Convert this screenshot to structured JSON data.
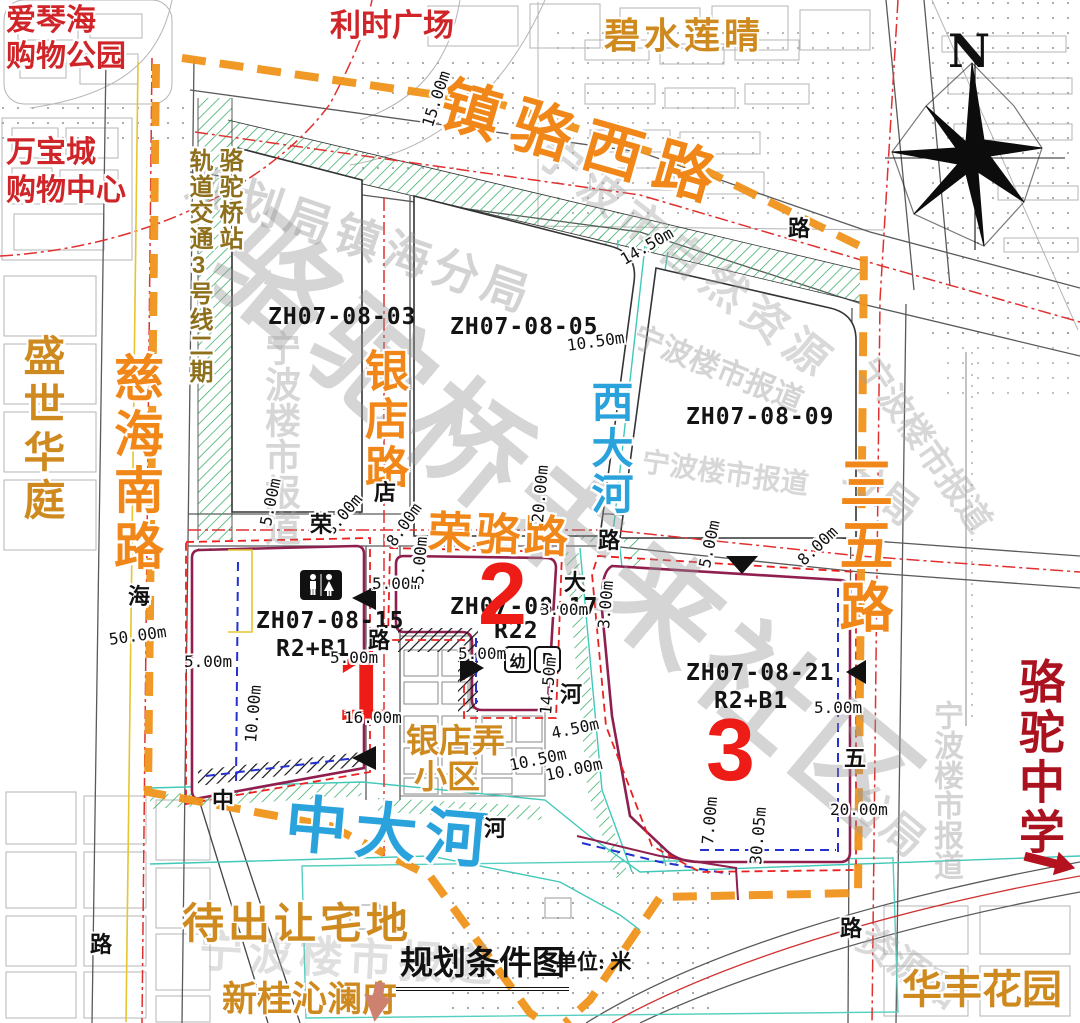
{
  "title": {
    "text": "规划条件图",
    "unit": "单位: 米"
  },
  "compass": {
    "north": "N"
  },
  "roads": {
    "zhenluo_west": "镇骆西路",
    "cihai_south": "慈海南路",
    "yindian": "银店路",
    "rongluo": "荣骆路",
    "sanwu": "三五路"
  },
  "rivers": {
    "zhongda": "中大河",
    "xida": "西大河"
  },
  "rail": {
    "line": "轨道交通3号线二期",
    "station": "骆驼桥站"
  },
  "landmarks": {
    "aiqinhai_1": "爱琴海",
    "aiqinhai_2": "购物公园",
    "lishi": "利时广场",
    "bishui": "碧水莲晴",
    "wanbao_1": "万宝城",
    "wanbao_2": "购物中心",
    "shengshi": "盛世华庭",
    "daichurang": "待出让宅地",
    "xingui": "新桂沁澜府",
    "huafeng": "华丰花园",
    "luotuo_school": "骆驼中学",
    "yindianlong_1": "银店弄",
    "yindianlong_2": "小区"
  },
  "parcels": {
    "p03": {
      "id": "ZH07-08-03"
    },
    "p05": {
      "id": "ZH07-08-05"
    },
    "p09": {
      "id": "ZH07-08-09"
    },
    "p15": {
      "id": "ZH07-08-15",
      "use": "R2+B1",
      "num": "1"
    },
    "p17": {
      "id": "ZH07-08-17",
      "use": "R22",
      "num": "2",
      "kindergarten": "幼",
      "parking": "P"
    },
    "p21": {
      "id": "ZH07-08-21",
      "use": "R2+B1",
      "num": "3"
    }
  },
  "dims": {
    "d01": "15.00m",
    "d02": "14.50m",
    "d03": "10.50m",
    "d04": "5.00m",
    "d05": "8.00m",
    "d06": "8.00m",
    "d07": "5.00m",
    "d08": "20.00m",
    "d09": "5.00m",
    "d10": "3.00m",
    "d11": "5.00m",
    "d12": "3.00m",
    "d13": "5.00m",
    "d14": "8.00m",
    "d15": "5.00m",
    "d16": "20.00m",
    "d17": "7.00m",
    "d18": "30.05m",
    "d19": "16.00m",
    "d20": "10.00m",
    "d21": "5.00m",
    "d22": "50.00m",
    "d23": "5.00m",
    "d24": "14.50m",
    "d25": "10.50m",
    "d26": "10.00m",
    "d27": "4.50m"
  },
  "road_chars": {
    "rong": "荣",
    "dian": "店",
    "lu1": "路",
    "hai": "海",
    "zhong": "中",
    "he1": "河",
    "da": "大",
    "he2": "河",
    "lu2": "路",
    "lu3": "路",
    "wu": "五",
    "lu4": "路",
    "lu5": "路"
  },
  "watermarks": {
    "w1": "骆驼桥未来社区",
    "w2": "规划局镇海分局",
    "w3": "宁波市自然资源",
    "w4": "宁波楼市报道",
    "w5": "宁波楼市报道",
    "w6": "宁波楼市报道",
    "w7": "宁波楼市报道",
    "w8": "宁波楼市报道",
    "w9": "宁波楼市报道",
    "w10": "分局",
    "w11": "分局",
    "w12": "资源和"
  },
  "colors": {
    "road_label_orange": "#f08718",
    "river_label_blue": "#2aa3dc",
    "landmark_red": "#cf2428",
    "landmark_orange": "#cf8a1f",
    "rail_olive": "#8d6f1c",
    "school_red": "#ab1220",
    "parcel_number_red": "#ee1c16",
    "boundary_dash_orange": "#f0941c",
    "parcel_boundary_maroon": "#8f1f4e",
    "regulation_red": "#e03030",
    "inner_blue": "#2430cf",
    "green_hatch": "#35ad63",
    "river_cyan": "#40c8b8"
  }
}
